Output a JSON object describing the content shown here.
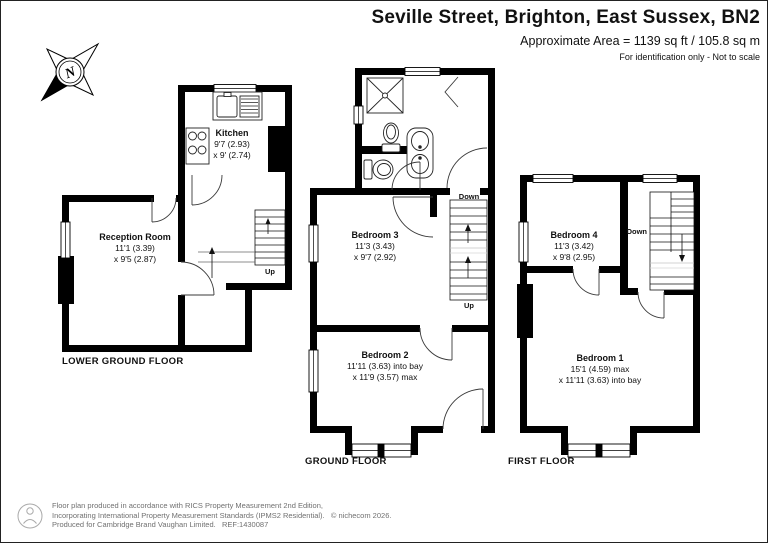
{
  "header": {
    "title": "Seville Street, Brighton, East Sussex, BN2",
    "area": "Approximate Area = 1139 sq ft / 105.8 sq m",
    "note": "For identification only - Not to scale"
  },
  "compass": {
    "north": "N"
  },
  "floors": {
    "lower": "LOWER GROUND FLOOR",
    "ground": "GROUND FLOOR",
    "first": "FIRST FLOOR"
  },
  "rooms": {
    "kitchen": {
      "name": "Kitchen",
      "dim1": "9'7 (2.93)",
      "dim2": "x 9' (2.74)"
    },
    "reception": {
      "name": "Reception Room",
      "dim1": "11'1 (3.39)",
      "dim2": "x 9'5 (2.87)"
    },
    "bedroom3": {
      "name": "Bedroom 3",
      "dim1": "11'3 (3.43)",
      "dim2": "x 9'7 (2.92)"
    },
    "bedroom2": {
      "name": "Bedroom 2",
      "dim1": "11'11 (3.63) into bay",
      "dim2": "x 11'9 (3.57) max"
    },
    "bedroom4": {
      "name": "Bedroom 4",
      "dim1": "11'3 (3.42)",
      "dim2": "x 9'8 (2.95)"
    },
    "bedroom1": {
      "name": "Bedroom 1",
      "dim1": "15'1 (4.59) max",
      "dim2": "x 11'11 (3.63) into bay"
    }
  },
  "stairs": {
    "lgf_up": "Up",
    "gf_down": "Down",
    "gf_up": "Up",
    "ff_down": "Down"
  },
  "footer": {
    "lines": [
      "Floor plan produced in accordance with RICS Property Measurement 2nd Edition,",
      "Incorporating International Property Measurement Standards (IPMS2 Residential).   © nichecom 2026.",
      "Produced for Cambridge Brand Vaughan Limited.   REF:1430087"
    ]
  },
  "colors": {
    "wall": "#000000",
    "doorline": "#3a3a3a"
  }
}
